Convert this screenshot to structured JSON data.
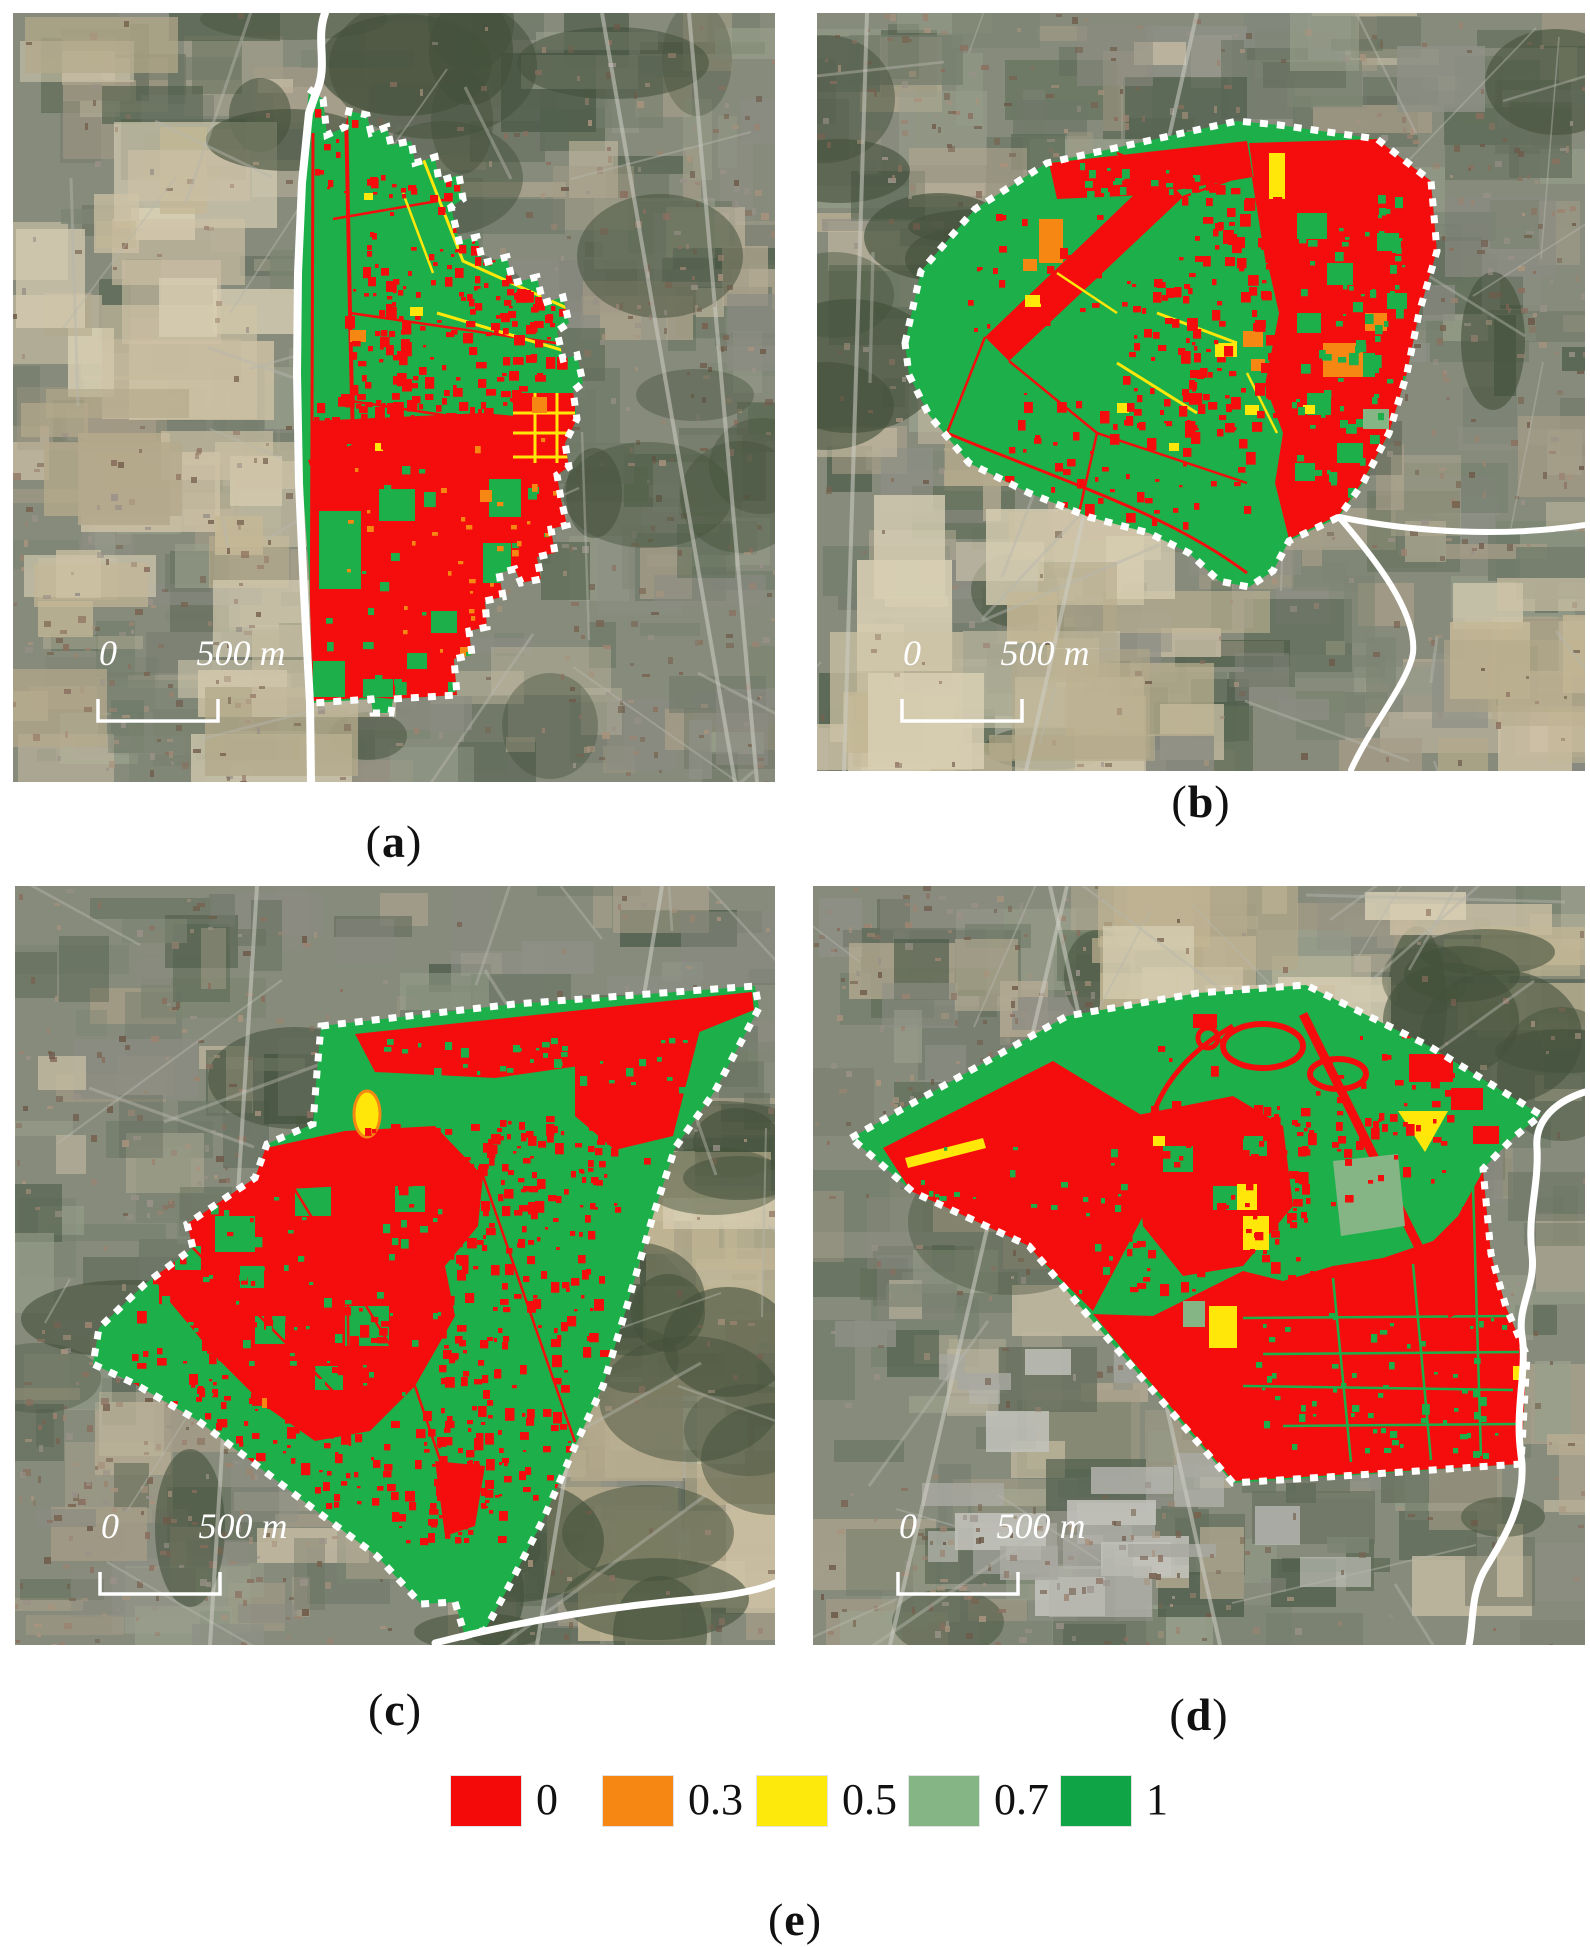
{
  "figure": {
    "panels": [
      {
        "id": "a",
        "caption": {
          "open": "(",
          "letter": "a",
          "close": ")"
        },
        "scalebar": {
          "zero": "0",
          "distance": "500 m"
        }
      },
      {
        "id": "b",
        "caption": {
          "open": "(",
          "letter": "b",
          "close": ")"
        },
        "scalebar": {
          "zero": "0",
          "distance": "500 m"
        }
      },
      {
        "id": "c",
        "caption": {
          "open": "(",
          "letter": "c",
          "close": ")"
        },
        "scalebar": {
          "zero": "0",
          "distance": "500 m"
        }
      },
      {
        "id": "d",
        "caption": {
          "open": "(",
          "letter": "d",
          "close": ")"
        },
        "scalebar": {
          "zero": "0",
          "distance": "500 m"
        }
      }
    ],
    "bottom_caption": {
      "open": "(",
      "letter": "e",
      "close": ")"
    },
    "legend": {
      "items": [
        {
          "label": "0",
          "color": "#f50a0a"
        },
        {
          "label": "0.3",
          "color": "#f68712"
        },
        {
          "label": "0.5",
          "color": "#fde90b"
        },
        {
          "label": "0.7",
          "color": "#85b585"
        },
        {
          "label": "1",
          "color": "#0fa546"
        }
      ]
    },
    "map_colors": {
      "suitability_0": "#f50d0d",
      "suitability_03": "#f68712",
      "suitability_05": "#ffe70a",
      "suitability_07": "#85b585",
      "suitability_1": "#1db04a",
      "boundary_dotted": "#ffffff",
      "admin_line": "#ffffff"
    }
  }
}
